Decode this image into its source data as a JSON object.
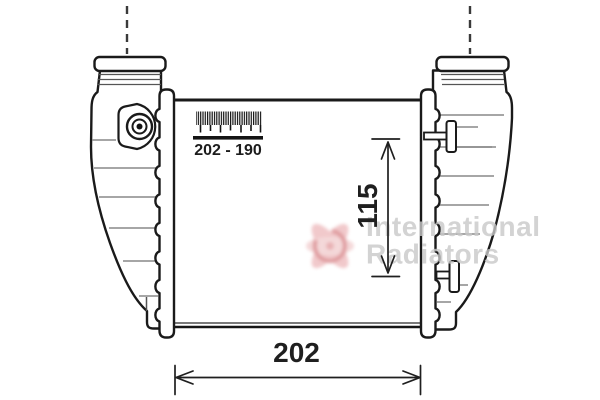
{
  "product_drawing": {
    "dimension_width": "202",
    "dimension_pin_spacing": "115",
    "scale_range": "202 - 190"
  },
  "watermark": {
    "line1": "International",
    "line2": "Radiators"
  },
  "colors": {
    "outline": "#1a1a1a",
    "rib_gray": "#888888",
    "watermark_gray": "#c8c8c8",
    "logo_pink": "#efc0c2",
    "logo_red": "#dc8f93",
    "background": "#ffffff"
  }
}
